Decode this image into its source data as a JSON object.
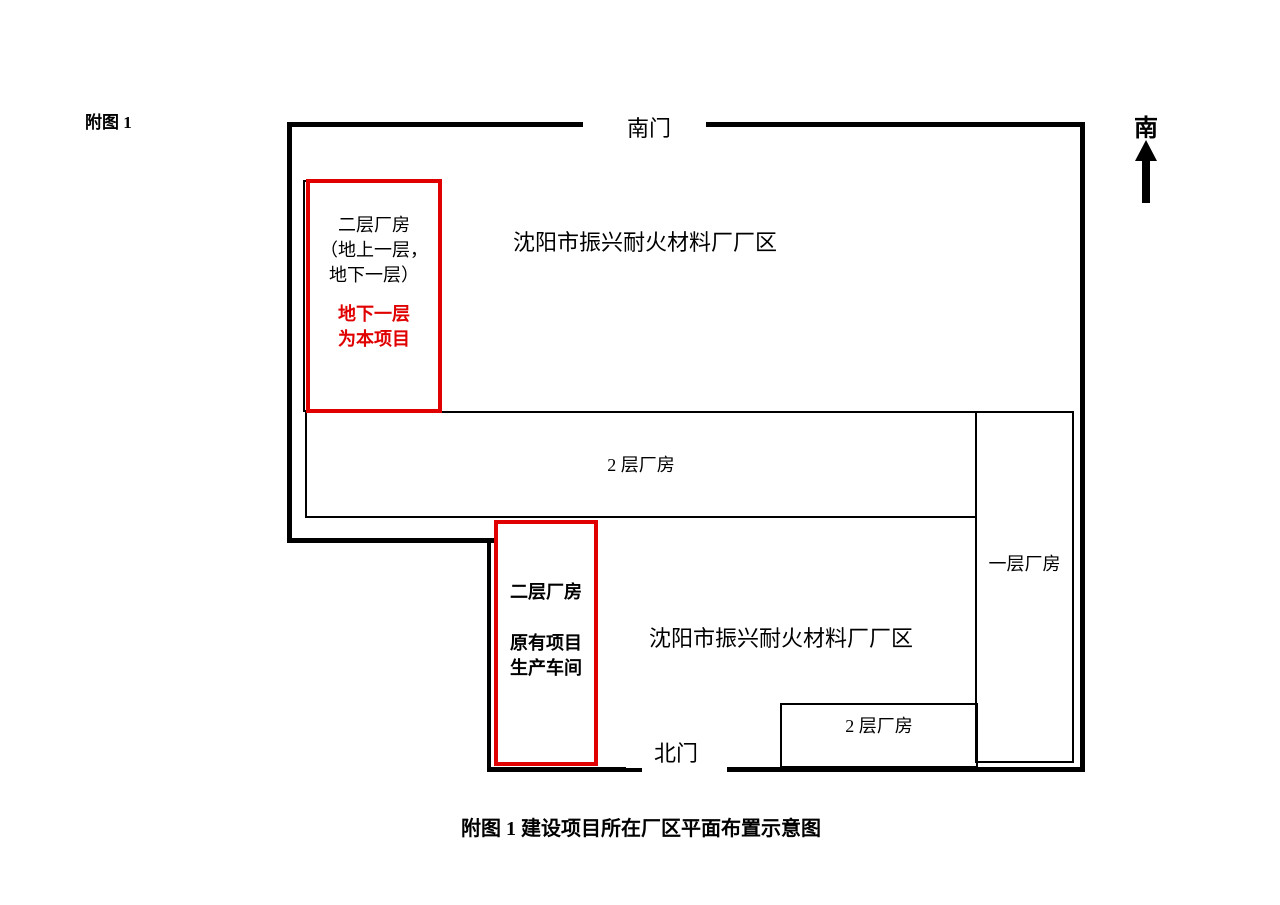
{
  "figure": {
    "tag": "附图 1",
    "caption": "附图 1 建设项目所在厂区平面布置示意图"
  },
  "compass": {
    "south_label": "南",
    "arrow_icon": "up-arrow-icon"
  },
  "gates": {
    "south_gate": "南门",
    "north_gate": "北门"
  },
  "areas": {
    "upper_label": "沈阳市振兴耐火材料厂厂区",
    "lower_label": "沈阳市振兴耐火材料厂厂区"
  },
  "buildings": {
    "project": {
      "line1": "二层厂房",
      "line2": "（地上一层，",
      "line3": "地下一层）",
      "highlight1": "地下一层",
      "highlight2": "为本项目"
    },
    "existing": {
      "line1": "二层厂房",
      "line2": "原有项目",
      "line3": "生产车间"
    },
    "long_two_storey": "2 层厂房",
    "one_storey": "一层厂房",
    "small_two_storey": "2 层厂房"
  },
  "colors": {
    "highlight_red": "#e00000",
    "line_black": "#000000",
    "background": "#ffffff"
  }
}
